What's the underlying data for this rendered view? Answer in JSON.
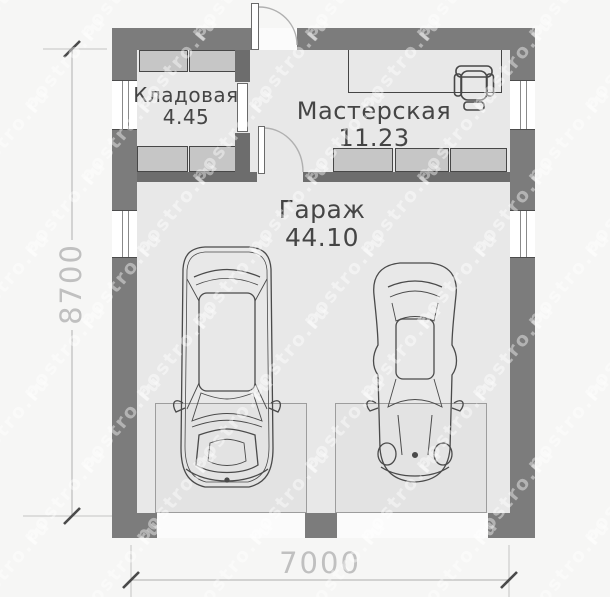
{
  "plan": {
    "type": "floor-plan",
    "rooms": {
      "storage": {
        "name": "Кладовая",
        "area": "4.45"
      },
      "workshop": {
        "name": "Мастерская",
        "area": "11.23"
      },
      "garage": {
        "name": "Гараж",
        "area": "44.10"
      }
    },
    "dimensions": {
      "width_mm": "7000",
      "height_mm": "8700"
    },
    "features": [
      "entry-door-top",
      "interior-door-workshop",
      "interior-door-storage",
      "windows-left-2",
      "windows-right-2",
      "garage-doors-2",
      "workbench-desk",
      "office-chair",
      "car-suv",
      "car-sports"
    ]
  },
  "watermark": {
    "text": "postro.ru"
  },
  "colors": {
    "wall": "#7c7c7c",
    "floor": "#e8e8e8",
    "shelf": "#c6c6c6",
    "dimension": "#c0c0c0",
    "label": "#454545",
    "background": "#f6f6f5"
  }
}
